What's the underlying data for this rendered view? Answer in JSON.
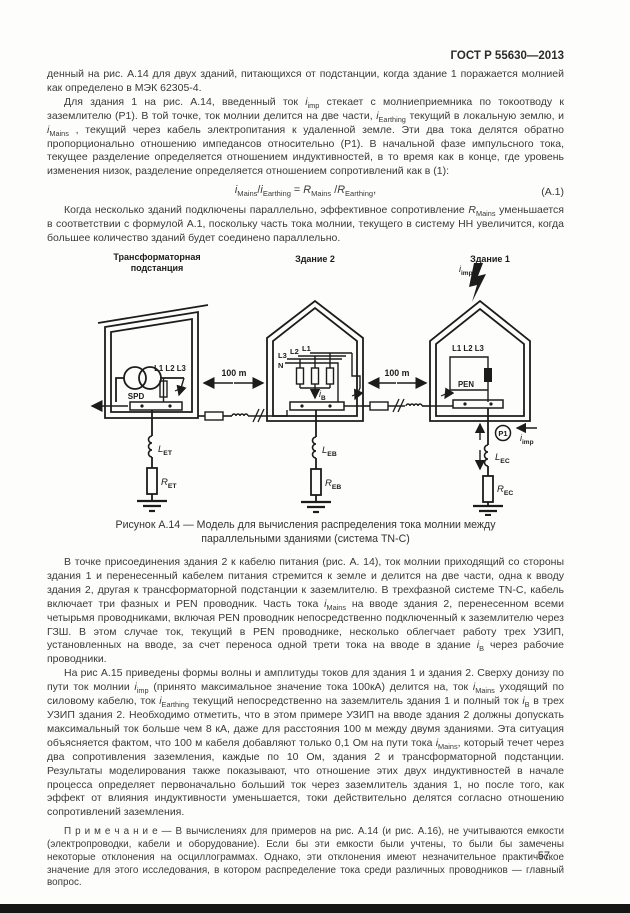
{
  "header": {
    "doc_number": "ГОСТ Р 55630—2013"
  },
  "page": {
    "number": "57"
  },
  "body": {
    "para_a": [
      {
        "t": "денный на рис. А.14 для двух зданий, питающихся от подстанции, когда здание 1 поражается молнией как определено в МЭК 62305-4."
      }
    ],
    "para_b": [
      {
        "t": "Для здания 1 на рис. А.14,  введенный  ток "
      },
      {
        "b": "i",
        "sub": "imp"
      },
      {
        "t": " стекает с молниеприемника по токоотводу к заземлителю (Р1). В той точке, ток молнии  делится на две части, "
      },
      {
        "b": "i",
        "sub": "Earthing"
      },
      {
        "t": " текущий в локальную землю, и "
      },
      {
        "b": "i",
        "sub": "Mains"
      },
      {
        "t": " , текущий через кабель электропитания к удаленной земле. Эти два тока делятся  обратно пропорционально отношению импедансов относительно (Р1). В начальной фазе импульсного тока, текущее разделение определяется отношением индуктивностей, в то время как в конце, где уровень изменения низок, разделение определяется отношением сопротивлений как в (1):"
      }
    ],
    "formula": {
      "segments": [
        {
          "b": "i",
          "sub": "Mains"
        },
        {
          "t": "/"
        },
        {
          "b": "i",
          "sub": "Earthing"
        },
        {
          "t": " = "
        },
        {
          "b": "R",
          "sub": "Mains"
        },
        {
          "t": " /"
        },
        {
          "b": "R",
          "sub": "Earthing"
        },
        {
          "t": ","
        }
      ],
      "label": "(А.1)"
    },
    "para_c": [
      {
        "t": "Когда несколько зданий подключены параллельно, эффективное сопротивление "
      },
      {
        "b": "R",
        "sub": "Mains"
      },
      {
        "t": "  уменьшается в соответствии с формулой А.1, поскольку часть тока молнии, текущего в систему НН увеличится, когда большее количество зданий будет соединено  параллельно."
      }
    ],
    "para_d": [
      {
        "t": "В точке присоединения здания 2 к кабелю питания (рис. А. 14), ток молнии приходящий со стороны здания 1 и перенесенный  кабелем питания стремится к земле и делится на две части, одна к вводу здания 2, другая к трансформаторной подстанции к заземлителю. В трехфазной системе TN-C, кабель включает три фазных и PEN проводник. Часть тока "
      },
      {
        "b": "i",
        "sub": "Mains"
      },
      {
        "t": " на вводе здания 2, перенесенном всеми четырьмя проводниками, включая PEN проводник  непосредственно  подключенный  к  заземлителю  через  ГЗШ.  В этом случае ток, текущий в PEN проводнике, несколько облегчает работу трех УЗИП, установленных на вводе, за счет переноса одной трети тока на вводе в здание "
      },
      {
        "b": "i",
        "sub": "B"
      },
      {
        "t": "  через рабочие проводники."
      }
    ],
    "para_e": [
      {
        "t": "На рис А.15 приведены формы волны и амплитуды токов для здания 1 и здания 2. Сверху донизу по пути  ток молнии "
      },
      {
        "b": "i",
        "sub": "imp"
      },
      {
        "t": " (принято максимальное значение тока 100кА) делится на, ток "
      },
      {
        "b": "i",
        "sub": "Mains"
      },
      {
        "t": " уходящий по силовому кабелю, ток "
      },
      {
        "b": "i",
        "sub": "Earthing"
      },
      {
        "t": " текущий непосредственно на заземлитель здания 1 и полный ток "
      },
      {
        "b": "i",
        "sub": "B"
      },
      {
        "t": " в трех УЗИП здания 2. Необходимо отметить, что в этом примере УЗИП на вводе здания 2 должны допускать максимальный ток больше чем 8 кА, даже для расстояния 100 м между двумя зданиями. Эта ситуация объясняется фактом, что 100 м кабеля добавляют только 0,1 Ом на пути тока "
      },
      {
        "b": "i",
        "sub": "Mains"
      },
      {
        "t": ", который течет через два сопротивления заземления, каждые по 10 Ом, здания 2 и трансформаторной подстанции. Результаты моделирования также показывают, что отношение этих двух индуктивностей в начале процесса определяет первоначально больший ток через заземлитель здания 1, но после того, как эффект от влияния индуктивности уменьшается, токи действительно делятся согласно отношению сопротивлений заземления."
      }
    ],
    "note": [
      {
        "t": "П р и м е ч а н и е — В вычислениях для примеров на рис. А.14 (и рис. А.16), не учитываются емкости (электропроводки, кабели и оборудование). Если бы эти емкости были учтены, то были бы замечены некоторые отклонения на осциллограммах. Однако, эти отклонения имеют незначительное практическое значение для этого исследования, в котором распределение тока среди различных проводников — главный вопрос."
      }
    ]
  },
  "figure": {
    "caption_line1": "Рисунок А.14 — Модель для вычисления распределения тока молнии между",
    "caption_line2": "параллельными зданиями (система TN-C)",
    "distance_left": "100 m",
    "distance_right": "100 m",
    "substation": {
      "title_line1": "Трансформаторная",
      "title_line2": "подстанция",
      "phases": "L1 L2 L3",
      "spd": "SPD",
      "l": {
        "base": "L",
        "sub": "ET"
      },
      "r": {
        "base": "R",
        "sub": "ET"
      }
    },
    "building2": {
      "title": "Здание 2",
      "l1": "L1",
      "l2": "L2",
      "l3": "L3",
      "n": "N",
      "ib": {
        "base": "i",
        "sub": "B"
      },
      "l": {
        "base": "L",
        "sub": "EB"
      },
      "r": {
        "base": "R",
        "sub": "EB"
      }
    },
    "building1": {
      "title": "Здание 1",
      "phases": "L1 L2 L3",
      "pen": "PEN",
      "p1": "Р1",
      "iimp_top": {
        "base": "i",
        "sub": "imp"
      },
      "iimp_bottom": {
        "base": "i",
        "sub": "imp"
      },
      "l": {
        "base": "L",
        "sub": "EC"
      },
      "r": {
        "base": "R",
        "sub": "EC"
      }
    }
  }
}
